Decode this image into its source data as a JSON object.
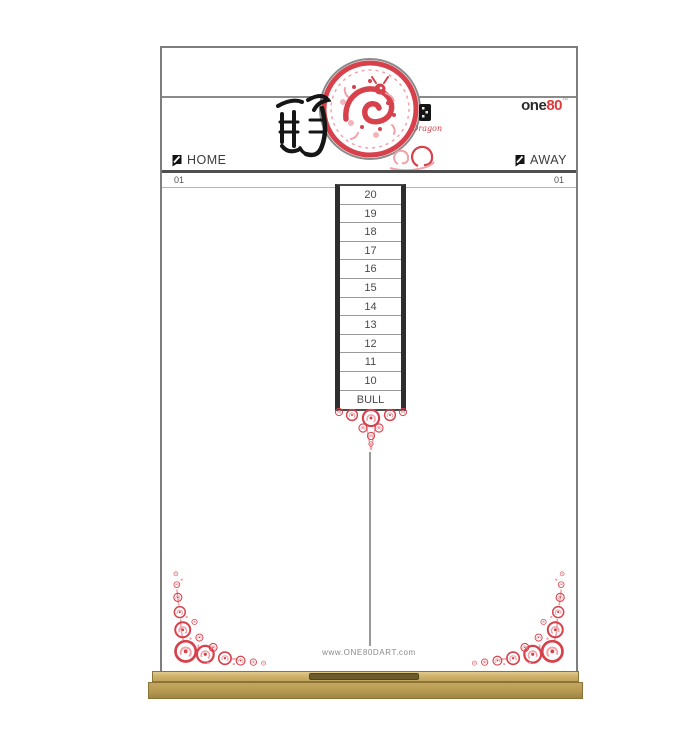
{
  "brand": {
    "prefix": "one",
    "suffix": "80",
    "trademark": "™"
  },
  "header": {
    "home_label": "HOME",
    "away_label": "AWAY",
    "home_game_label": "01",
    "away_game_label": "01",
    "dragon_label": "Dragon"
  },
  "score_column": {
    "rows": [
      "20",
      "19",
      "18",
      "17",
      "16",
      "15",
      "14",
      "13",
      "12",
      "11",
      "10",
      "BULL"
    ]
  },
  "footer": {
    "website": "www.ONE80DART.com"
  },
  "icons": {
    "medallion": "chinese-papercut-dragon-medallion",
    "calligraphy": "dragon-character-calligraphy",
    "seal": "red-seal-stamp",
    "flight": "dart-flight-icon",
    "corner": "floral-corner-ornament",
    "divider": "floral-v-divider"
  },
  "colors": {
    "accent_red": "#d7414b",
    "pink": "#f0a3ab",
    "ink": "#1c1c1c",
    "line_gray": "#8a8a8a",
    "text_gray": "#4a4a4a",
    "wood_light": "#cfb36b",
    "wood": "#b69a52",
    "wood_dark": "#6b5a2c",
    "logo_red": "#e03a3c"
  }
}
